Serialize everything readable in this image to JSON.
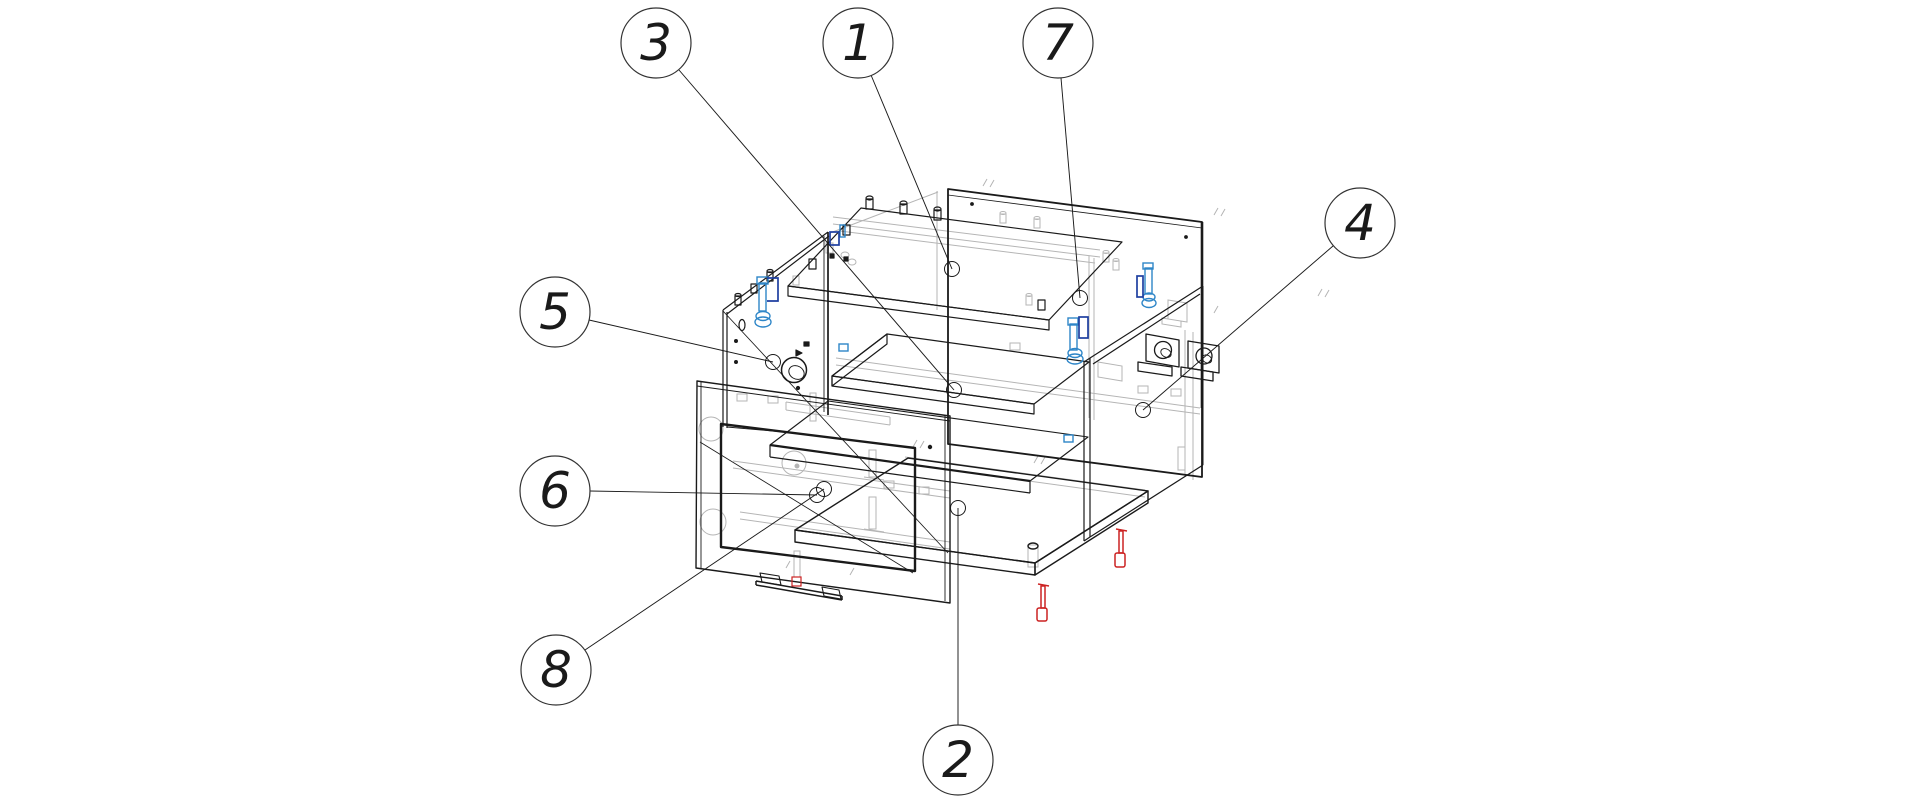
{
  "figure": {
    "type": "exploded-view-technical-drawing",
    "background": "#ffffff",
    "line_color": "#1a1a1a",
    "hidden_line_color": "#b5b5b5",
    "colors": {
      "fastener_blue": "#2e86c8",
      "fastener_blue_dark": "#1e3fa0",
      "fastener_red": "#cc2222",
      "balloon_stroke": "#333333"
    },
    "endpoint_radius": 7.5,
    "balloon_radius": 35,
    "callouts": [
      {
        "label": "1",
        "cx": 858,
        "cy": 43,
        "lx1": 871,
        "ly1": 75,
        "lx2": 952,
        "ly2": 269
      },
      {
        "label": "3",
        "cx": 656,
        "cy": 43,
        "lx1": 679,
        "ly1": 70,
        "lx2": 954,
        "ly2": 390
      },
      {
        "label": "7",
        "cx": 1058,
        "cy": 43,
        "lx1": 1061,
        "ly1": 78,
        "lx2": 1080,
        "ly2": 298
      },
      {
        "label": "4",
        "cx": 1360,
        "cy": 223,
        "lx1": 1333,
        "ly1": 246,
        "lx2": 1143,
        "ly2": 410
      },
      {
        "label": "5",
        "cx": 555,
        "cy": 312,
        "lx1": 589,
        "ly1": 320,
        "lx2": 773,
        "ly2": 362
      },
      {
        "label": "6",
        "cx": 555,
        "cy": 491,
        "lx1": 590,
        "ly1": 491,
        "lx2": 817,
        "ly2": 495
      },
      {
        "label": "8",
        "cx": 556,
        "cy": 670,
        "lx1": 585,
        "ly1": 650,
        "lx2": 824,
        "ly2": 489
      },
      {
        "label": "2",
        "cx": 958,
        "cy": 760,
        "lx1": 958,
        "ly1": 725,
        "lx2": 958,
        "ly2": 508
      }
    ]
  }
}
